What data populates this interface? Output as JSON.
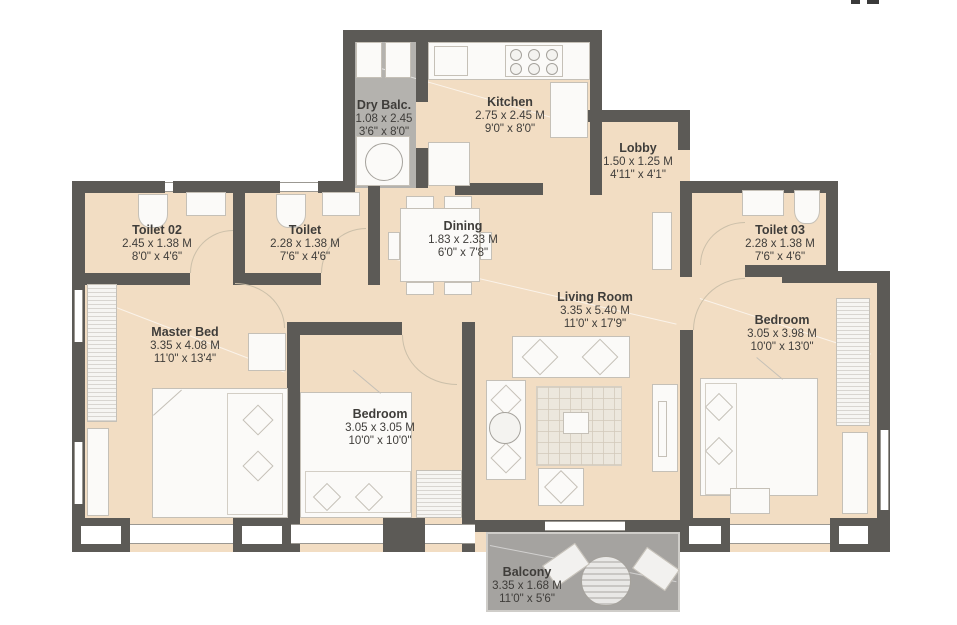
{
  "rooms": {
    "dry_balc": {
      "name": "Dry Balc.",
      "metric": "1.08 x 2.45",
      "imperial": "3'6\" x 8'0\""
    },
    "kitchen": {
      "name": "Kitchen",
      "metric": "2.75 x 2.45 M",
      "imperial": "9'0\" x 8'0\""
    },
    "lobby": {
      "name": "Lobby",
      "metric": "1.50 x 1.25 M",
      "imperial": "4'11\" x 4'1\""
    },
    "toilet_02": {
      "name": "Toilet 02",
      "metric": "2.45 x 1.38 M",
      "imperial": "8'0\" x 4'6\""
    },
    "toilet": {
      "name": "Toilet",
      "metric": "2.28 x 1.38 M",
      "imperial": "7'6\" x 4'6\""
    },
    "dining": {
      "name": "Dining",
      "metric": "1.83 x 2.33 M",
      "imperial": "6'0\" x 7'8\""
    },
    "toilet_03": {
      "name": "Toilet 03",
      "metric": "2.28 x 1.38 M",
      "imperial": "7'6\" x 4'6\""
    },
    "living_room": {
      "name": "Living Room",
      "metric": "3.35 x 5.40 M",
      "imperial": "11'0\" x 17'9\""
    },
    "master_bed": {
      "name": "Master Bed",
      "metric": "3.35 x 4.08 M",
      "imperial": "11'0\" x 13'4\""
    },
    "bedroom_mid": {
      "name": "Bedroom",
      "metric": "3.05 x 3.05 M",
      "imperial": "10'0\" x 10'0\""
    },
    "bedroom_right": {
      "name": "Bedroom",
      "metric": "3.05 x 3.98 M",
      "imperial": "10'0\" x 13'0\""
    },
    "balcony": {
      "name": "Balcony",
      "metric": "3.35 x 1.68 M",
      "imperial": "11'0\" x 5'6\""
    }
  },
  "colors": {
    "floor": "#f2ddc3",
    "wall": "#5c5a56",
    "service_floor": "#b4b2ae",
    "balcony_floor": "#a5a3a0",
    "label_text": "#3f3d3a"
  }
}
